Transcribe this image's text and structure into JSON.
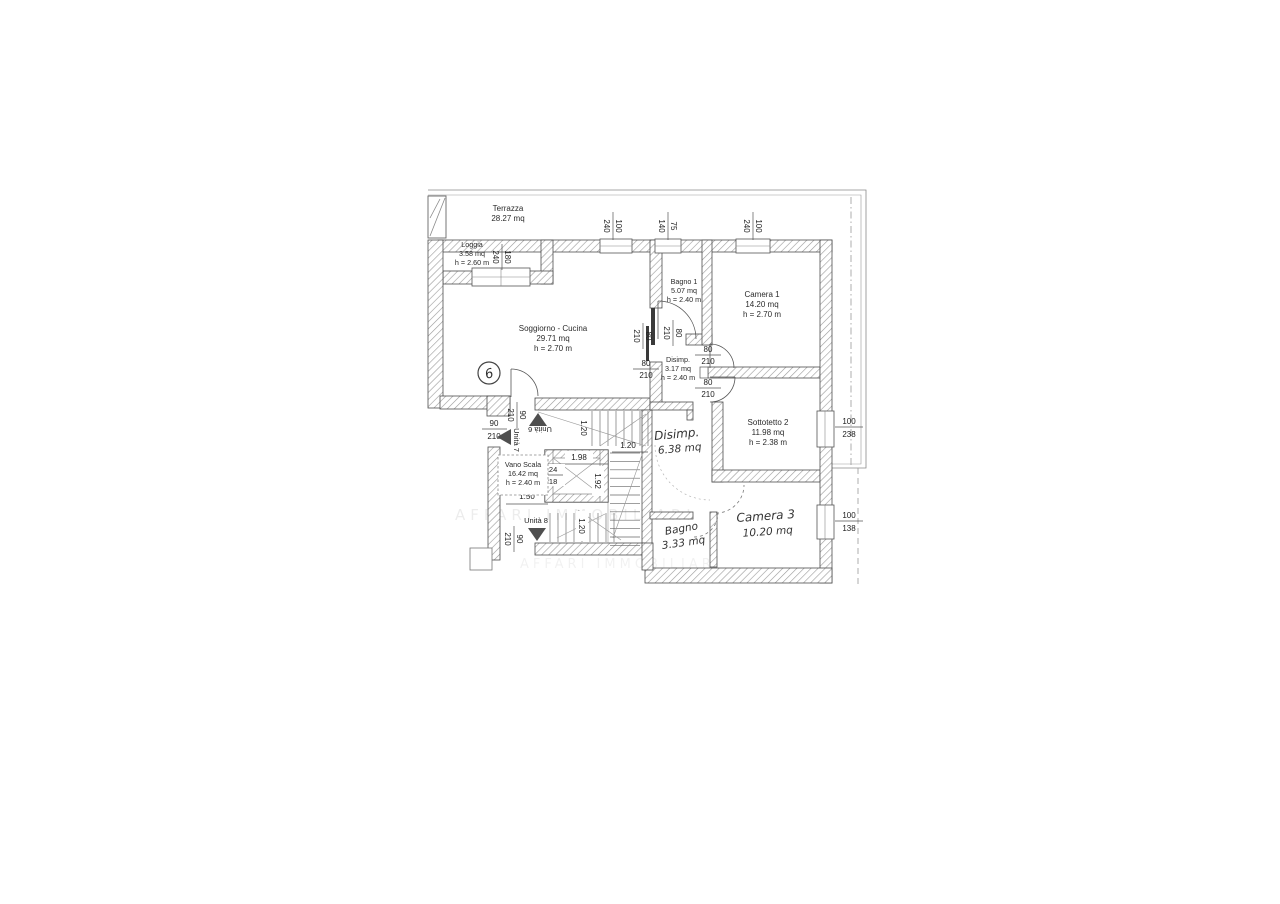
{
  "plan": {
    "rooms": {
      "terrazza": {
        "name": "Terrazza",
        "area": "28.27 mq"
      },
      "loggia": {
        "name": "Loggia",
        "area": "3.58 mq",
        "height": "h = 2.60 m"
      },
      "soggiorno": {
        "name": "Soggiorno - Cucina",
        "area": "29.71 mq",
        "height": "h = 2.70 m"
      },
      "bagno1": {
        "name": "Bagno 1",
        "area": "5.07 mq",
        "height": "h = 2.40 m"
      },
      "camera1": {
        "name": "Camera 1",
        "area": "14.20 mq",
        "height": "h = 2.70 m"
      },
      "disimp1": {
        "name": "Disimp.",
        "area": "3.17 mq",
        "height": "h = 2.40 m"
      },
      "sottotetto2": {
        "name": "Sottotetto 2",
        "area": "11.98 mq",
        "height": "h = 2.38 m"
      },
      "vano_scala": {
        "name": "Vano Scala",
        "area": "16.42 mq",
        "height": "h = 2.40 m"
      },
      "disimp2": {
        "name": "Disimp.",
        "area": "6.38 mq"
      },
      "bagno2": {
        "name": "Bagno",
        "area": "3.33 mq"
      },
      "camera3": {
        "name": "Camera 3",
        "area": "10.20 mq"
      }
    },
    "units": {
      "u6": "Unità 6",
      "u7": "Unità 7",
      "u8": "Unità 8",
      "circle": "6"
    },
    "windows": {
      "loggia": {
        "num": "180",
        "den": "240"
      },
      "sogg_top": {
        "num": "100",
        "den": "240"
      },
      "bagno1_top": {
        "num": "75",
        "den": "140"
      },
      "camera1_top": {
        "num": "100",
        "den": "240"
      },
      "sott_right": {
        "num": "100",
        "den": "238"
      },
      "cam3_right": {
        "num": "100",
        "den": "138"
      }
    },
    "doors": {
      "d80": {
        "num": "80",
        "den": "210"
      },
      "d90": {
        "num": "90",
        "den": "210"
      }
    },
    "stairs": {
      "d198": "1.98",
      "d124": "124",
      "d218": "218",
      "d192": "1.92",
      "d120": "1.20",
      "d150": "1.50"
    },
    "watermark": "AFFARI IMMOBILIARI"
  }
}
